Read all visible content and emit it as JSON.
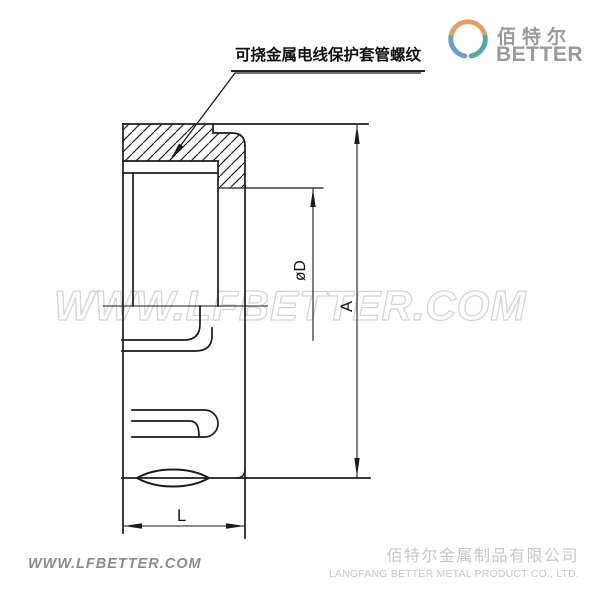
{
  "annotation": {
    "label": "可挠金属电线保护套管螺纹"
  },
  "brand": {
    "name_cn": "佰特尔",
    "name_en": "BETTER"
  },
  "watermark": {
    "text": "WWW.LFBETTER.COM"
  },
  "dimensions": {
    "diameter": "øD",
    "overall": "A",
    "length": "L"
  },
  "footer": {
    "website": "WWW.LFBETTER.COM",
    "company_cn": "佰特尔金属制品有限公司",
    "company_en": "LANGFANG BETTER METAL PRODUCT CO., LTD."
  },
  "colors": {
    "line": "#1b1b1b",
    "watermark_stroke": "#d5d5d5",
    "brand_text": "#9a9a9a",
    "logo_orange": "#e0a264",
    "logo_green": "#8fb05c",
    "logo_blue": "#6f9bc8",
    "logo_teal": "#56a79e",
    "footer_left_text": "#8c8c8c",
    "footer_right_text": "#c7c7c7"
  }
}
